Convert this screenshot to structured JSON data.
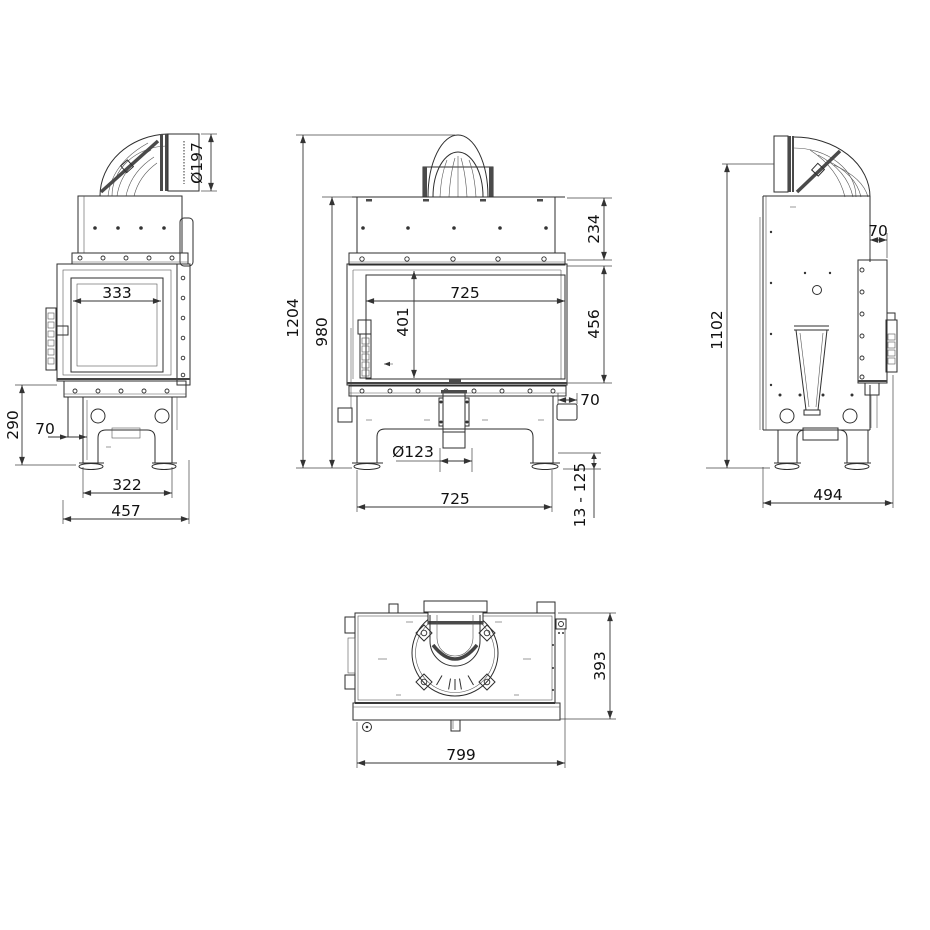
{
  "colors": {
    "background": "#ffffff",
    "lines": "#2e2e2e",
    "text": "#111111"
  },
  "views": {
    "left_side": {
      "dims": {
        "flue_diameter": "Ø197",
        "glass_width": "333",
        "base_height": "290",
        "front_offset": "70",
        "leg_spacing": "322",
        "overall_depth": "457"
      }
    },
    "front": {
      "dims": {
        "overall_height": "1204",
        "body_height": "980",
        "hood_height": "234",
        "glass_width": "725",
        "glass_height": "401",
        "door_height": "456",
        "rear_spigot_depth": "70",
        "air_inlet_diameter": "Ø123",
        "base_width": "725",
        "foot_adjust_range": "13 - 125"
      }
    },
    "right_side": {
      "dims": {
        "flue_axis_height": "1102",
        "rear_spigot_depth": "70",
        "overall_depth": "494"
      }
    },
    "top": {
      "dims": {
        "depth": "393",
        "width": "799"
      }
    }
  }
}
